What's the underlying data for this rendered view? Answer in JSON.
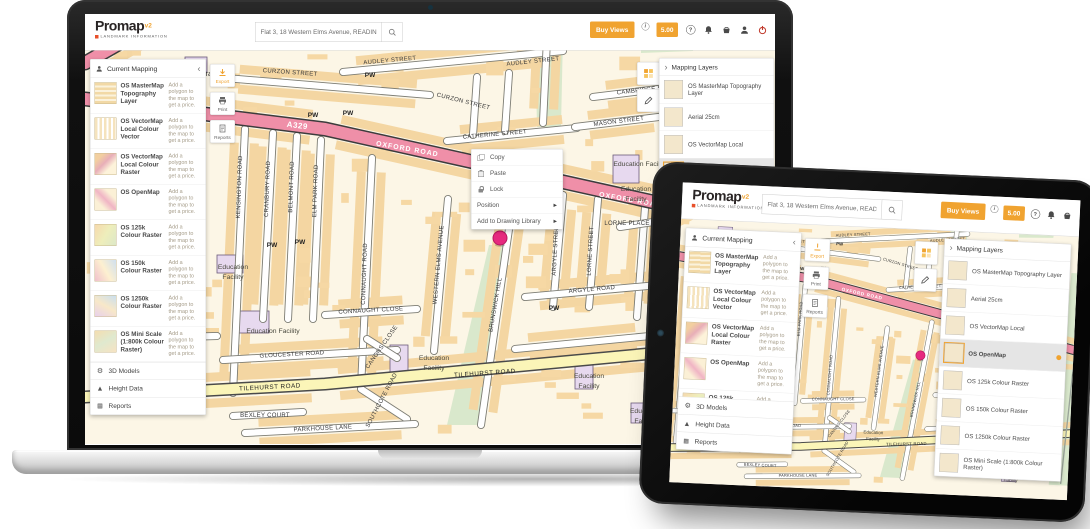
{
  "colors": {
    "accent_orange": "#f0a330",
    "brand_black": "#292424",
    "logout_red": "#c0392b",
    "selected_row": "#e5e5e5",
    "pin_pink": "#e62a7f",
    "road_pink": "#ef8fa8",
    "road_yellow": "#fbf5b8",
    "building_sand": "#f6d8a4",
    "map_green": "#d9e8cc",
    "map_purple": "#e7d9ef"
  },
  "app": {
    "header": {
      "logo_text": "Promap",
      "logo_sup": "v2",
      "logo_subtext": "LANDMARK INFORMATION",
      "search_value": "Flat 3, 18 Western Elms Avenue, READING, Berk",
      "buy_views_label": "Buy Views",
      "credit_value": "5.00"
    },
    "current_mapping": {
      "title": "Current Mapping",
      "price_note": "Add a polygon to the map to get a price.",
      "items": [
        {
          "name": "OS MasterMap Topography Layer",
          "thumb": "t1"
        },
        {
          "name": "OS VectorMap Local Colour Vector",
          "thumb": "t2"
        },
        {
          "name": "OS VectorMap Local Colour Raster",
          "thumb": "t3"
        },
        {
          "name": "OS OpenMap",
          "thumb": "t4"
        },
        {
          "name": "OS 125k Colour Raster",
          "thumb": "t5"
        },
        {
          "name": "OS 150k Colour Raster",
          "thumb": "t6"
        },
        {
          "name": "OS 1250k Colour Raster",
          "thumb": "t7"
        },
        {
          "name": "OS Mini Scale (1:800k Colour Raster)",
          "thumb": "t8"
        }
      ],
      "footer_items": [
        {
          "label": "3D Models",
          "icon": "gear-icon"
        },
        {
          "label": "Height Data",
          "icon": "mountain-icon"
        },
        {
          "label": "Reports",
          "icon": "report-icon"
        }
      ]
    },
    "left_tools": [
      {
        "label": "Export"
      },
      {
        "label": "Print"
      },
      {
        "label": "Reports"
      }
    ],
    "context_menu": {
      "items": [
        {
          "label": "Copy",
          "icon": "ic-copy"
        },
        {
          "label": "Paste",
          "icon": "ic-paste"
        },
        {
          "label": "Lock",
          "icon": "ic-lock"
        },
        {
          "label": "Position",
          "submenu": true
        },
        {
          "label": "Add to Drawing Library",
          "submenu": true
        }
      ]
    },
    "mapping_layers": {
      "title": "Mapping Layers",
      "items": [
        {
          "name": "OS MasterMap Topography Layer",
          "thumb": "t1"
        },
        {
          "name": "Aerial 25cm",
          "thumb": "t-aerial"
        },
        {
          "name": "OS VectorMap Local",
          "thumb": "t3"
        },
        {
          "name": "OS OpenMap",
          "thumb": "t4",
          "selected": true
        },
        {
          "name": "OS 125k Colour Raster",
          "thumb": "t5"
        },
        {
          "name": "OS 150k Colour Raster",
          "thumb": "t6"
        },
        {
          "name": "OS 1250k Colour Raster",
          "thumb": "t7"
        },
        {
          "name": "OS Mini Scale (1:800k Colour Raster)",
          "thumb": "t8"
        }
      ]
    }
  },
  "map": {
    "pin": {
      "x": 415,
      "y": 221
    },
    "pin_color": "#e62a7f",
    "labels": [
      {
        "t": "A329",
        "x": 212,
        "y": 111,
        "r": 7,
        "c": "badge"
      },
      {
        "t": "OXFORD ROAD",
        "x": 322,
        "y": 134,
        "r": 10,
        "c": "pink"
      },
      {
        "t": "OXFORD ROAD",
        "x": 545,
        "y": 185,
        "r": 10,
        "c": "pink"
      },
      {
        "t": "CURZON STREET",
        "x": 205,
        "y": 57,
        "r": 4
      },
      {
        "t": "CURZON STREET",
        "x": 378,
        "y": 86,
        "r": 14
      },
      {
        "t": "AUDLEY STREET",
        "x": 305,
        "y": 45,
        "r": -5
      },
      {
        "t": "AUDLEY STREET",
        "x": 448,
        "y": 46,
        "r": -6
      },
      {
        "t": "CATHERINE STREET",
        "x": 410,
        "y": 119,
        "r": -5
      },
      {
        "t": "MASON STREET",
        "x": 534,
        "y": 106,
        "r": -7
      },
      {
        "t": "CAMBRIDGE STREET",
        "x": 565,
        "y": 74,
        "r": -6
      },
      {
        "t": "KENSINGTON ROAD",
        "x": 156,
        "y": 170,
        "r": -88
      },
      {
        "t": "CRANBURY ROAD",
        "x": 184,
        "y": 172,
        "r": -88
      },
      {
        "t": "BELMONT ROAD",
        "x": 208,
        "y": 170,
        "r": -88
      },
      {
        "t": "ELM PARK ROAD",
        "x": 232,
        "y": 174,
        "r": -88
      },
      {
        "t": "CONNAUGHT ROAD",
        "x": 281,
        "y": 257,
        "r": -88
      },
      {
        "t": "CONNAUGHT CLOSE",
        "x": 286,
        "y": 295,
        "r": -3
      },
      {
        "t": "WESTERN ELMS AVENUE",
        "x": 355,
        "y": 248,
        "r": -85
      },
      {
        "t": "BRUNSWICK HILL",
        "x": 412,
        "y": 288,
        "r": -80
      },
      {
        "t": "ARGYLE STREET",
        "x": 472,
        "y": 232,
        "r": -87
      },
      {
        "t": "LORNE STREET",
        "x": 507,
        "y": 234,
        "r": -87
      },
      {
        "t": "LORNE PLACE",
        "x": 542,
        "y": 208,
        "r": 0
      },
      {
        "t": "ARGYLE ROAD",
        "x": 507,
        "y": 274,
        "r": -5
      },
      {
        "t": "GLOUCESTER ROAD",
        "x": 207,
        "y": 339,
        "r": -3
      },
      {
        "t": "TILEHURST ROAD",
        "x": 185,
        "y": 372,
        "r": -3,
        "c": "dark"
      },
      {
        "t": "TILEHURST ROAD",
        "x": 400,
        "y": 358,
        "r": -4,
        "c": "dark"
      },
      {
        "t": "KENT ROAD",
        "x": 80,
        "y": 319,
        "r": 2
      },
      {
        "t": "SOUTHCOTE ROAD",
        "x": 298,
        "y": 384,
        "r": -62
      },
      {
        "t": "CANONS CLOSE",
        "x": 298,
        "y": 331,
        "r": -55
      },
      {
        "t": "BEXLEY COURT",
        "x": 180,
        "y": 400,
        "r": 0
      },
      {
        "t": "PARKHOUSE LANE",
        "x": 238,
        "y": 413,
        "r": -3
      },
      {
        "t": "Education Facility",
        "x": 188,
        "y": 316,
        "c": "poi"
      },
      {
        "t": "Education",
        "x": 148,
        "y": 252,
        "c": "poi"
      },
      {
        "t": "Facility",
        "x": 148,
        "y": 262,
        "c": "poi"
      },
      {
        "t": "Education Facility",
        "x": 555,
        "y": 149,
        "c": "poi"
      },
      {
        "t": "Education",
        "x": 551,
        "y": 174,
        "c": "poi"
      },
      {
        "t": "Facility",
        "x": 551,
        "y": 184,
        "c": "poi"
      },
      {
        "t": "Education",
        "x": 349,
        "y": 343,
        "c": "poi"
      },
      {
        "t": "Facility",
        "x": 349,
        "y": 353,
        "c": "poi"
      },
      {
        "t": "Education",
        "x": 504,
        "y": 361,
        "c": "poi"
      },
      {
        "t": "Facility",
        "x": 504,
        "y": 371,
        "c": "poi"
      },
      {
        "t": "Education",
        "x": 560,
        "y": 396,
        "c": "poi"
      },
      {
        "t": "Facility",
        "x": 560,
        "y": 406,
        "c": "poi"
      },
      {
        "t": "Library",
        "x": 122,
        "y": 59,
        "c": "poilg"
      },
      {
        "t": "PW",
        "x": 228,
        "y": 100,
        "c": "pw"
      },
      {
        "t": "PW",
        "x": 263,
        "y": 98,
        "c": "pw"
      },
      {
        "t": "PW",
        "x": 187,
        "y": 230,
        "c": "pw"
      },
      {
        "t": "PW",
        "x": 215,
        "y": 227,
        "c": "pw"
      },
      {
        "t": "PW",
        "x": 469,
        "y": 293,
        "c": "pw"
      },
      {
        "t": "PW",
        "x": 98,
        "y": 362,
        "c": "pw"
      },
      {
        "t": "PW",
        "x": 285,
        "y": 60,
        "c": "pw"
      }
    ]
  }
}
